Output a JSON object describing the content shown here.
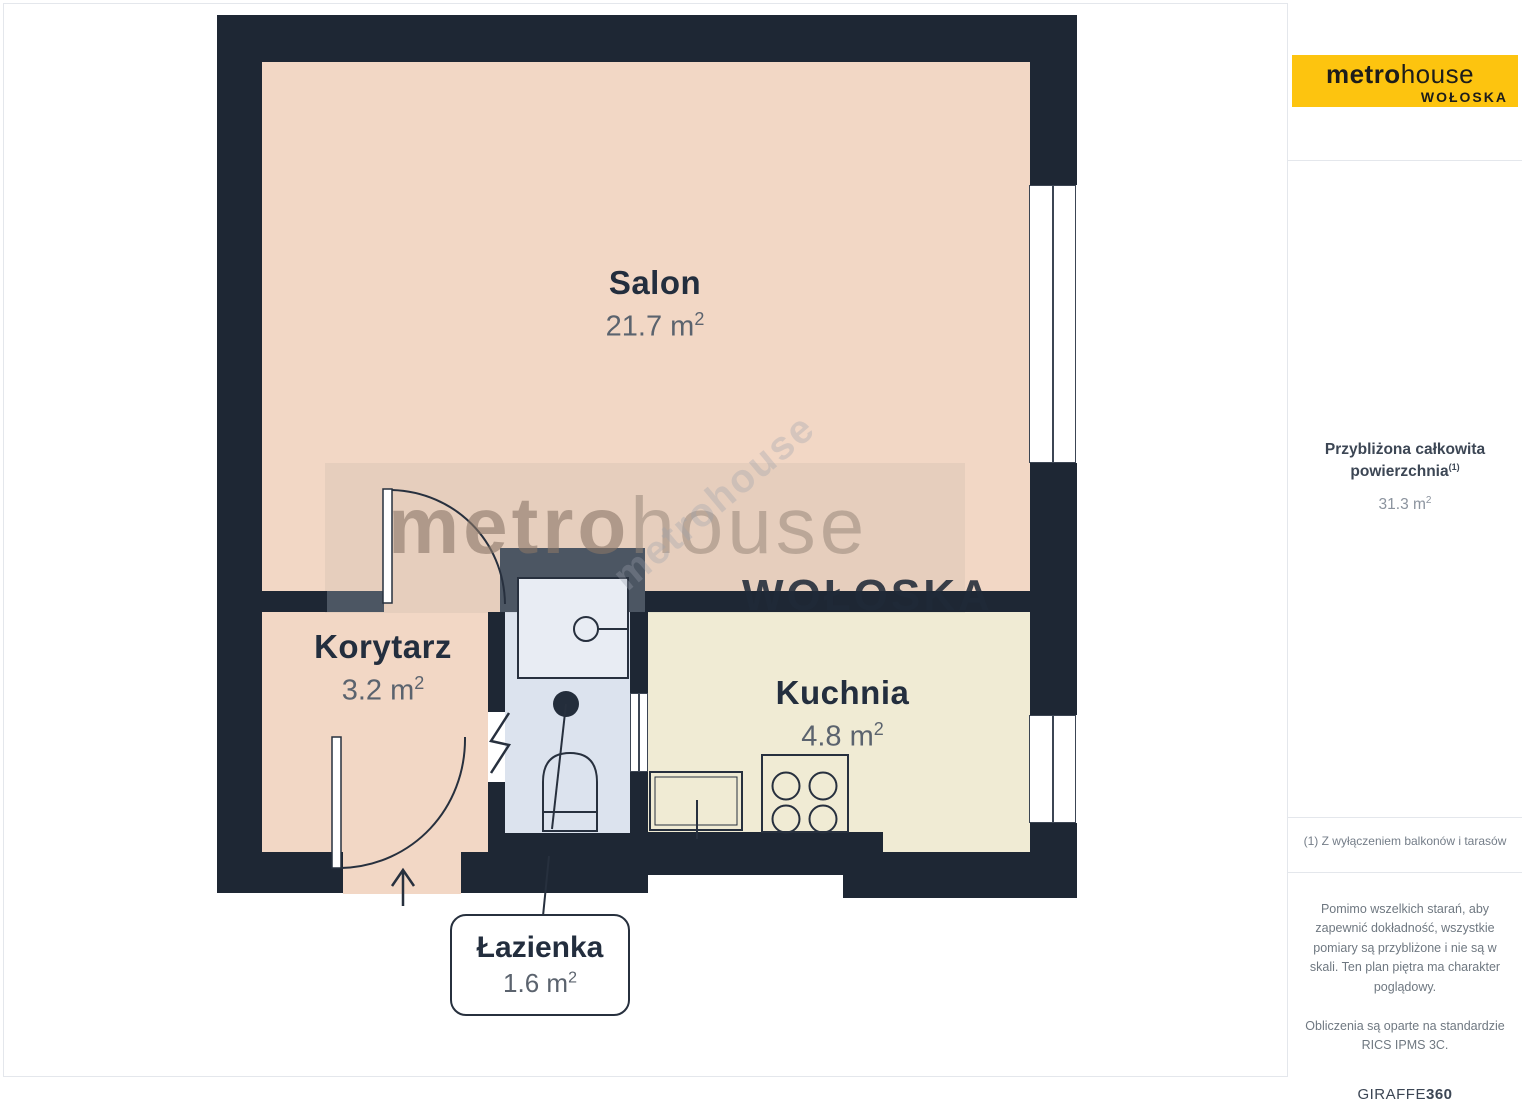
{
  "plan": {
    "rooms": [
      {
        "name": "Salon",
        "area": "21.7 m",
        "sup": "2"
      },
      {
        "name": "Korytarz",
        "area": "3.2 m",
        "sup": "2"
      },
      {
        "name": "Kuchnia",
        "area": "4.8 m",
        "sup": "2"
      },
      {
        "name": "Łazienka",
        "area": "1.6 m",
        "sup": "2"
      }
    ],
    "watermark": {
      "bold": "metro",
      "light": "house",
      "sub": "WOŁOSKA",
      "diagonal": "metrohouse"
    },
    "colors": {
      "wall": "#1e2734",
      "wall_gray": "#4c5663",
      "salon_floor": "#f2d7c5",
      "kitchen_floor": "#f0ebd4",
      "bathroom_floor": "#dce3ee",
      "logo_yellow": "#fdc40f",
      "label_navy": "#232e3e",
      "label_gray": "#5b636e"
    }
  },
  "sidebar": {
    "logo": {
      "bold": "metro",
      "light": "house",
      "sub": "WOŁOSKA"
    },
    "area_label_line1": "Przybliżona całkowita",
    "area_label_line2": "powierzchnia",
    "area_label_sup": "(1)",
    "area_value": "31.3 m",
    "area_value_sup": "2",
    "footnote": "(1) Z wyłączeniem balkonów i tarasów",
    "disclaimer_p1": "Pomimo wszelkich starań, aby zapewnić dokładność, wszystkie pomiary są przybliżone i nie są w skali. Ten plan piętra ma charakter poglądowy.",
    "disclaimer_p2": "Obliczenia są oparte na standardzie RICS IPMS 3C.",
    "brand": "GIRAFFE",
    "brand_bold": "360"
  }
}
